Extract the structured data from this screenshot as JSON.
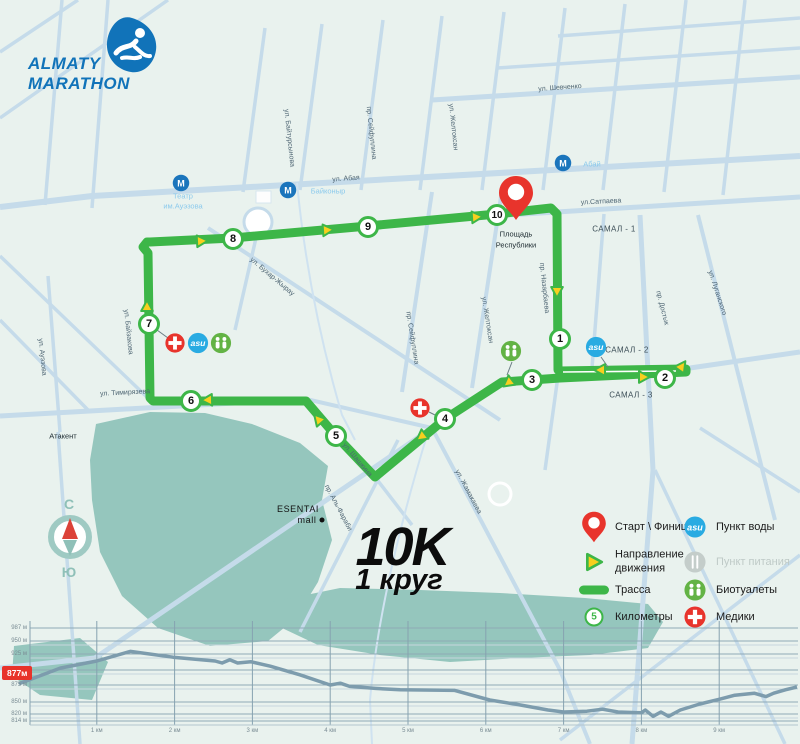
{
  "logo": {
    "line1": "ALMATY",
    "line2": "MARATHON"
  },
  "title": {
    "distance": "10K",
    "lap": "1 круг"
  },
  "compass": {
    "north": "С",
    "south": "Ю"
  },
  "map": {
    "street_labels": [
      {
        "t": "ул. Шевченко",
        "x": 560,
        "y": 88,
        "r": -4
      },
      {
        "t": "ул. Абая",
        "x": 346,
        "y": 179,
        "r": -4
      },
      {
        "t": "ул.Сатпаева",
        "x": 601,
        "y": 202,
        "r": -3
      },
      {
        "t": "ул. Тимирязева",
        "x": 125,
        "y": 393,
        "r": -3
      },
      {
        "t": "ул. Байтурсынова",
        "x": 289,
        "y": 138,
        "r": 84
      },
      {
        "t": "пр. Сейфуллина",
        "x": 371,
        "y": 133,
        "r": 84
      },
      {
        "t": "ул. Желтоксан",
        "x": 453,
        "y": 127,
        "r": 84
      },
      {
        "t": "пр. Сейфуллина",
        "x": 412,
        "y": 338,
        "r": 81
      },
      {
        "t": "ул. Желтоксан",
        "x": 487,
        "y": 320,
        "r": 81
      },
      {
        "t": "пр. Назарбаева",
        "x": 544,
        "y": 288,
        "r": 84
      },
      {
        "t": "пр. Достык",
        "x": 662,
        "y": 308,
        "r": 76
      },
      {
        "t": "ул. Луганского",
        "x": 717,
        "y": 293,
        "r": 72
      },
      {
        "t": "ул. Байзакова",
        "x": 128,
        "y": 332,
        "r": 84
      },
      {
        "t": "ул. Ауэзова",
        "x": 42,
        "y": 357,
        "r": 84
      },
      {
        "t": "ул. Бухар-Жырау",
        "x": 272,
        "y": 277,
        "r": 40
      },
      {
        "t": "ул. Шашкина",
        "x": 357,
        "y": 460,
        "r": 50
      },
      {
        "t": "ул. Жамакаева",
        "x": 468,
        "y": 492,
        "r": 62
      },
      {
        "t": "пр. Аль-Фараби",
        "x": 338,
        "y": 508,
        "r": 62
      }
    ],
    "district_labels": [
      {
        "t": "САМАЛ - 1",
        "x": 614,
        "y": 229
      },
      {
        "t": "САМАЛ - 2",
        "x": 627,
        "y": 350
      },
      {
        "t": "САМАЛ - 3",
        "x": 631,
        "y": 395
      }
    ],
    "poi_labels": [
      {
        "t": "Театр",
        "x": 183,
        "y": 196,
        "c": "poiblue"
      },
      {
        "t": "им.Ауэзова",
        "x": 183,
        "y": 206,
        "c": "poiblue"
      },
      {
        "t": "Байконыр",
        "x": 328,
        "y": 191,
        "c": "poiblue"
      },
      {
        "t": "Абай",
        "x": 592,
        "y": 164,
        "c": "poiblue"
      },
      {
        "t": "Атакент",
        "x": 63,
        "y": 436,
        "c": "poidark"
      },
      {
        "t": "Площадь",
        "x": 516,
        "y": 234,
        "c": "poidark"
      },
      {
        "t": "Республики",
        "x": 516,
        "y": 245,
        "c": "poidark"
      },
      {
        "t": "ESENTAI",
        "x": 298,
        "y": 509,
        "c": "poibig"
      },
      {
        "t": "mall",
        "x": 307,
        "y": 520,
        "c": "poibig"
      }
    ],
    "metro_stations": [
      {
        "x": 181,
        "y": 183
      },
      {
        "x": 288,
        "y": 190
      },
      {
        "x": 563,
        "y": 163
      }
    ],
    "metro_letter": "М",
    "water_label": "asu",
    "route": {
      "color": "#3db648",
      "path": [
        [
          150,
          242
        ],
        [
          233,
          238
        ],
        [
          368,
          226
        ],
        [
          497,
          214
        ],
        [
          551,
          208
        ],
        [
          557,
          214
        ],
        [
          558,
          370
        ],
        [
          559,
          371
        ],
        [
          686,
          369
        ],
        [
          686,
          372
        ],
        [
          560,
          378
        ],
        [
          502,
          382
        ],
        [
          445,
          419
        ],
        [
          375,
          477
        ],
        [
          336,
          436
        ],
        [
          306,
          401
        ],
        [
          153,
          401
        ],
        [
          150,
          398
        ],
        [
          148,
          253
        ],
        [
          143,
          247
        ],
        [
          147,
          242
        ],
        [
          150,
          242
        ]
      ],
      "centerline": [
        [
          563,
          372
        ],
        [
          676,
          371
        ]
      ],
      "arrows": [
        {
          "x": 202,
          "y": 241,
          "r": -3
        },
        {
          "x": 328,
          "y": 230,
          "r": -4
        },
        {
          "x": 477,
          "y": 217,
          "r": -4
        },
        {
          "x": 557,
          "y": 292,
          "r": 90
        },
        {
          "x": 600,
          "y": 370,
          "r": 180
        },
        {
          "x": 644,
          "y": 377,
          "r": 0
        },
        {
          "x": 682,
          "y": 366,
          "r": -55
        },
        {
          "x": 508,
          "y": 383,
          "r": 143
        },
        {
          "x": 421,
          "y": 437,
          "r": 143
        },
        {
          "x": 318,
          "y": 419,
          "r": -131
        },
        {
          "x": 207,
          "y": 400,
          "r": 178
        },
        {
          "x": 147,
          "y": 306,
          "r": -90
        }
      ],
      "km_markers": [
        {
          "n": "1",
          "x": 560,
          "y": 339
        },
        {
          "n": "2",
          "x": 665,
          "y": 378
        },
        {
          "n": "3",
          "x": 532,
          "y": 380
        },
        {
          "n": "4",
          "x": 445,
          "y": 419
        },
        {
          "n": "5",
          "x": 336,
          "y": 436
        },
        {
          "n": "6",
          "x": 191,
          "y": 401
        },
        {
          "n": "7",
          "x": 149,
          "y": 324
        },
        {
          "n": "8",
          "x": 233,
          "y": 239
        },
        {
          "n": "9",
          "x": 368,
          "y": 227
        },
        {
          "n": "10",
          "x": 497,
          "y": 215
        }
      ],
      "start_pin": {
        "x": 516,
        "y": 198
      }
    },
    "aid_points": [
      {
        "type": "medic",
        "x": 175,
        "y": 343
      },
      {
        "type": "water",
        "x": 198,
        "y": 343
      },
      {
        "type": "bio",
        "x": 221,
        "y": 343
      },
      {
        "type": "medic",
        "x": 420,
        "y": 408
      },
      {
        "type": "bio",
        "x": 511,
        "y": 351
      },
      {
        "type": "water",
        "x": 596,
        "y": 347
      }
    ],
    "connectors": [
      [
        157,
        330,
        168,
        338
      ],
      [
        429,
        412,
        437,
        416
      ],
      [
        512,
        362,
        507,
        375
      ],
      [
        601,
        357,
        608,
        367
      ]
    ]
  },
  "legend": {
    "items": [
      {
        "icon": "pin",
        "label": "Старт \\ Финиш",
        "col": 0,
        "row": 0
      },
      {
        "icon": "arrow",
        "label": "Направление движения",
        "col": 0,
        "row": 1,
        "wrap": true
      },
      {
        "icon": "track",
        "label": "Трасса",
        "col": 0,
        "row": 2
      },
      {
        "icon": "km",
        "label": "Километры",
        "num": "5",
        "col": 0,
        "row": 3
      },
      {
        "icon": "water",
        "label": "Пункт воды",
        "col": 1,
        "row": 0
      },
      {
        "icon": "food",
        "label": "Пункт питания",
        "col": 1,
        "row": 1,
        "muted": true
      },
      {
        "icon": "bio",
        "label": "Биотуалеты",
        "col": 1,
        "row": 2
      },
      {
        "icon": "medic",
        "label": "Медики",
        "col": 1,
        "row": 3
      }
    ]
  },
  "chart_data": {
    "type": "line",
    "title": "Профиль высоты",
    "x_unit": "км",
    "y_unit": "м",
    "y_ticks": [
      "987 м",
      "950 м",
      "925 м",
      "900 м",
      "875 м",
      "850 м",
      "820 м",
      "814 м"
    ],
    "y_tick_values": [
      987,
      950,
      925,
      900,
      875,
      850,
      820,
      814
    ],
    "x_ticks": [
      "1 км",
      "2 км",
      "3 км",
      "4 км",
      "5 км",
      "6 км",
      "7 км",
      "8 км",
      "9 км"
    ],
    "x_tick_values": [
      1,
      2,
      3,
      4,
      5,
      6,
      7,
      8,
      9
    ],
    "x_range_km": [
      0,
      10
    ],
    "start_badge": "877м",
    "profile_km_elev": [
      [
        0,
        877
      ],
      [
        0.53,
        903
      ],
      [
        1.0,
        914
      ],
      [
        1.43,
        930
      ],
      [
        1.98,
        920
      ],
      [
        2.52,
        914
      ],
      [
        2.61,
        911
      ],
      [
        2.71,
        916
      ],
      [
        2.81,
        911
      ],
      [
        2.98,
        913
      ],
      [
        3.23,
        906
      ],
      [
        3.61,
        892
      ],
      [
        4.0,
        875
      ],
      [
        4.13,
        878
      ],
      [
        4.25,
        873
      ],
      [
        4.58,
        870
      ],
      [
        4.9,
        868
      ],
      [
        5.6,
        867
      ],
      [
        6.05,
        853
      ],
      [
        6.4,
        844
      ],
      [
        6.8,
        830
      ],
      [
        7.0,
        825
      ],
      [
        7.3,
        827
      ],
      [
        7.5,
        832
      ],
      [
        7.7,
        825
      ],
      [
        8.0,
        823
      ],
      [
        8.05,
        830
      ],
      [
        8.15,
        818
      ],
      [
        8.25,
        825
      ],
      [
        8.35,
        818
      ],
      [
        8.5,
        830
      ],
      [
        8.75,
        845
      ],
      [
        9.0,
        854
      ],
      [
        9.2,
        860
      ],
      [
        9.45,
        863
      ],
      [
        9.6,
        858
      ],
      [
        9.7,
        863
      ],
      [
        9.85,
        868
      ],
      [
        10.0,
        872
      ]
    ],
    "line_color": "#7d9cad"
  }
}
